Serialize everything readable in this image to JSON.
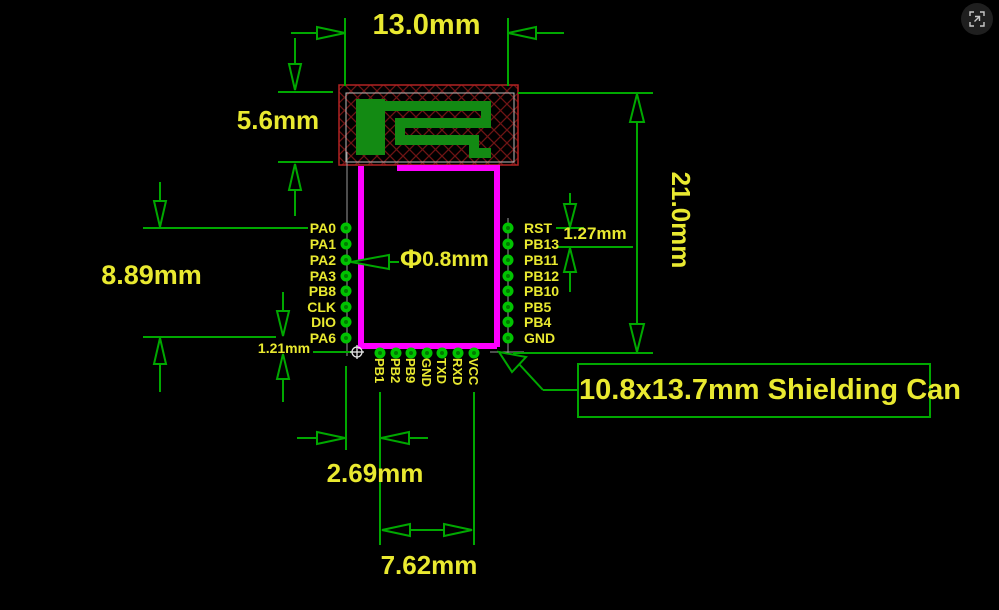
{
  "diagram": {
    "dimensions": {
      "top_width": "13.0mm",
      "antenna_height": "5.6mm",
      "left_pin_span": "8.89mm",
      "left_bottom_offset": "1.21mm",
      "right_pin_pitch": "1.27mm",
      "overall_height": "21.0mm",
      "pad_diameter_symbol": "Φ",
      "pad_diameter_value": "0.8mm",
      "bottom_first_pin_offset": "2.69mm",
      "bottom_pin_span": "7.62mm"
    },
    "callout": {
      "shielding_can": "10.8x13.7mm Shielding Can"
    },
    "pins": {
      "left": [
        "PA0",
        "PA1",
        "PA2",
        "PA3",
        "PB8",
        "CLK",
        "DIO",
        "PA6"
      ],
      "right": [
        "RST",
        "PB13",
        "PB11",
        "PB12",
        "PB10",
        "PB5",
        "PB4",
        "GND"
      ],
      "bottom": [
        "PB1",
        "PB2",
        "PB9",
        "GND",
        "TXD",
        "RXD",
        "VCC"
      ]
    },
    "colors": {
      "background": "#000000",
      "dimension_green": "#00a800",
      "label_yellow": "#e9e930",
      "shield_magenta": "#ff00ff",
      "pad_green": "#00c300",
      "antenna_copper": "#138a13",
      "keepout_red": "#b22222",
      "guide_gray": "#9a9a9a"
    },
    "viewer": {
      "expand_icon": "fullscreen-expand"
    }
  }
}
